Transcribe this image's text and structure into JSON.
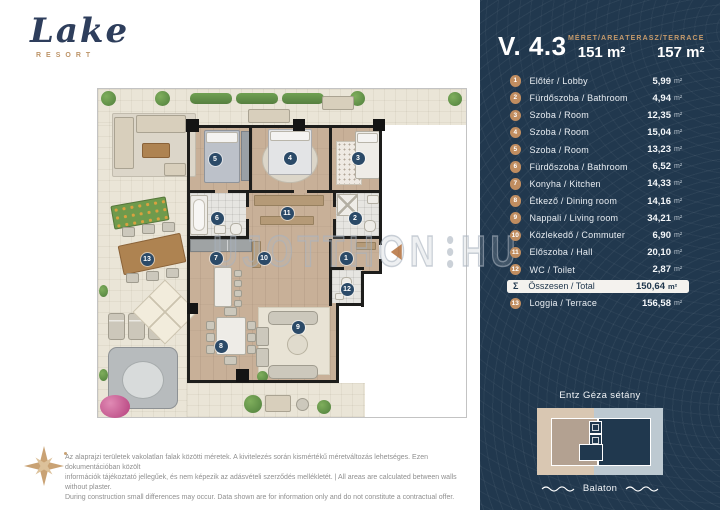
{
  "logo": {
    "name": "Lake",
    "subtitle": "RESORT"
  },
  "watermark": {
    "left": "UJOTTHON",
    "right": "HU"
  },
  "panel": {
    "unit_id": "V. 4.3",
    "area": {
      "label": "MÉRET/AREA",
      "value": "151 m²"
    },
    "terrace": {
      "label": "TERASZ/TERRACE",
      "value": "157 m²"
    },
    "rooms": [
      {
        "num": "1",
        "label": "Előtér / Lobby",
        "value": "5,99",
        "unit": "m²"
      },
      {
        "num": "2",
        "label": "Fürdőszoba / Bathroom",
        "value": "4,94",
        "unit": "m²"
      },
      {
        "num": "3",
        "label": "Szoba / Room",
        "value": "12,35",
        "unit": "m²"
      },
      {
        "num": "4",
        "label": "Szoba / Room",
        "value": "15,04",
        "unit": "m²"
      },
      {
        "num": "5",
        "label": "Szoba / Room",
        "value": "13,23",
        "unit": "m²"
      },
      {
        "num": "6",
        "label": "Fürdőszoba / Bathroom",
        "value": "6,52",
        "unit": "m²"
      },
      {
        "num": "7",
        "label": "Konyha / Kitchen",
        "value": "14,33",
        "unit": "m²"
      },
      {
        "num": "8",
        "label": "Étkező / Dining room",
        "value": "14,16",
        "unit": "m²"
      },
      {
        "num": "9",
        "label": "Nappali / Living room",
        "value": "34,21",
        "unit": "m²"
      },
      {
        "num": "10",
        "label": "Közlekedő / Commuter",
        "value": "6,90",
        "unit": "m²"
      },
      {
        "num": "11",
        "label": "Előszoba / Hall",
        "value": "20,10",
        "unit": "m²"
      },
      {
        "num": "12",
        "label": "WC / Toilet",
        "value": "2,87",
        "unit": "m²"
      }
    ],
    "total": {
      "symbol": "Σ",
      "label": "Összesen / Total",
      "value": "150,64",
      "unit": "m²"
    },
    "loggia": {
      "num": "13",
      "label": "Loggia / Terrace",
      "value": "156,58",
      "unit": "m²"
    },
    "site": {
      "street": "Entz Géza sétány",
      "lake": "Balaton"
    }
  },
  "floorplan": {
    "markers": [
      {
        "n": "1",
        "x": 248,
        "y": 169
      },
      {
        "n": "2",
        "x": 257,
        "y": 129
      },
      {
        "n": "3",
        "x": 260,
        "y": 69
      },
      {
        "n": "4",
        "x": 192,
        "y": 69
      },
      {
        "n": "5",
        "x": 117,
        "y": 70
      },
      {
        "n": "6",
        "x": 119,
        "y": 129
      },
      {
        "n": "7",
        "x": 118,
        "y": 169
      },
      {
        "n": "8",
        "x": 123,
        "y": 257
      },
      {
        "n": "9",
        "x": 200,
        "y": 238
      },
      {
        "n": "10",
        "x": 166,
        "y": 169
      },
      {
        "n": "11",
        "x": 189,
        "y": 124
      },
      {
        "n": "12",
        "x": 249,
        "y": 200
      },
      {
        "n": "13",
        "x": 49,
        "y": 170
      }
    ]
  },
  "disclaimer": {
    "lines": [
      "Az alaprajzi területek vakolatlan falak közötti méretek. A kivitelezés során kismértékű méretváltozás lehetséges. Ezen dokumentációban közölt",
      "információk tájékoztató jellegűek, és nem képezik az adásvételi szerződés mellékletét. | All areas are calculated between walls without plaster.",
      "During construction small differences may occur. Data shown are for information only and do not constitute a contractual offer."
    ]
  },
  "colors": {
    "panel": "#21384e",
    "accent_gold": "#c59a6b",
    "list_circle": "#c08d60",
    "plan_marker": "#2b4a68"
  }
}
